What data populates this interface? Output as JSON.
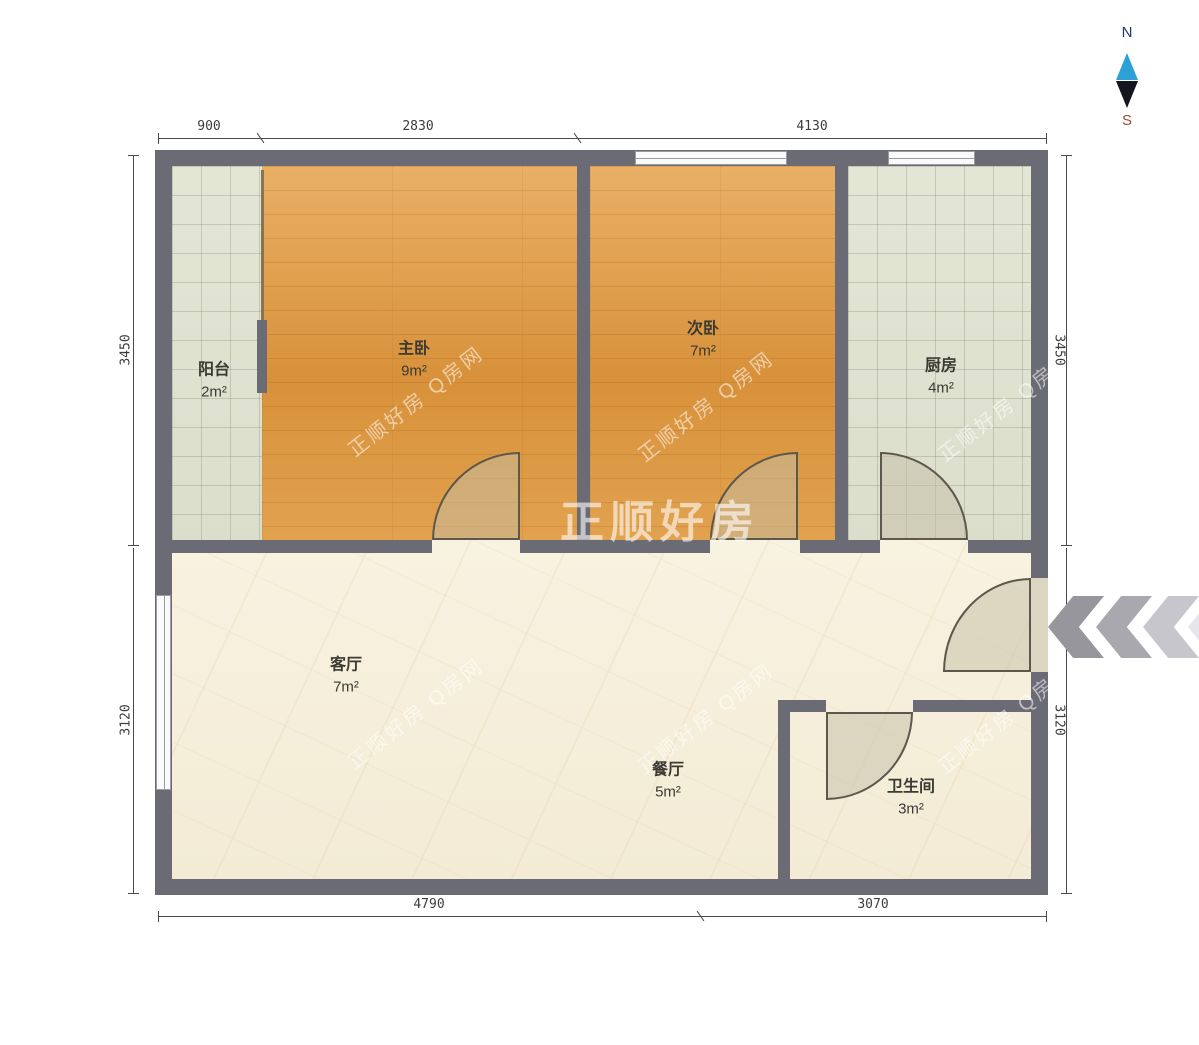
{
  "compass": {
    "north": "N",
    "south": "S"
  },
  "watermark": {
    "center": "正顺好房",
    "diagonal": "正顺好房 Q房网"
  },
  "rooms": {
    "balcony": {
      "name": "阳台",
      "area": "2m²"
    },
    "master_bedroom": {
      "name": "主卧",
      "area": "9m²"
    },
    "second_bedroom": {
      "name": "次卧",
      "area": "7m²"
    },
    "kitchen": {
      "name": "厨房",
      "area": "4m²"
    },
    "living_room": {
      "name": "客厅",
      "area": "7m²"
    },
    "dining_room": {
      "name": "餐厅",
      "area": "5m²"
    },
    "bathroom": {
      "name": "卫生间",
      "area": "3m²"
    }
  },
  "dimensions": {
    "top": {
      "d1": "900",
      "d2": "2830",
      "d3": "4130"
    },
    "bottom": {
      "d1": "4790",
      "d2": "3070"
    },
    "left": {
      "d1": "3450",
      "d2": "3120"
    },
    "right": {
      "d1": "3450",
      "d2": "3120"
    }
  },
  "colors": {
    "wall": "#6b6b76",
    "wood_floor": "#dd9a44",
    "tile_floor": "#dfe1d0",
    "marble_floor": "#f7f0dd",
    "compass_north": "#2da0d8",
    "compass_south": "#9c4a2f"
  }
}
